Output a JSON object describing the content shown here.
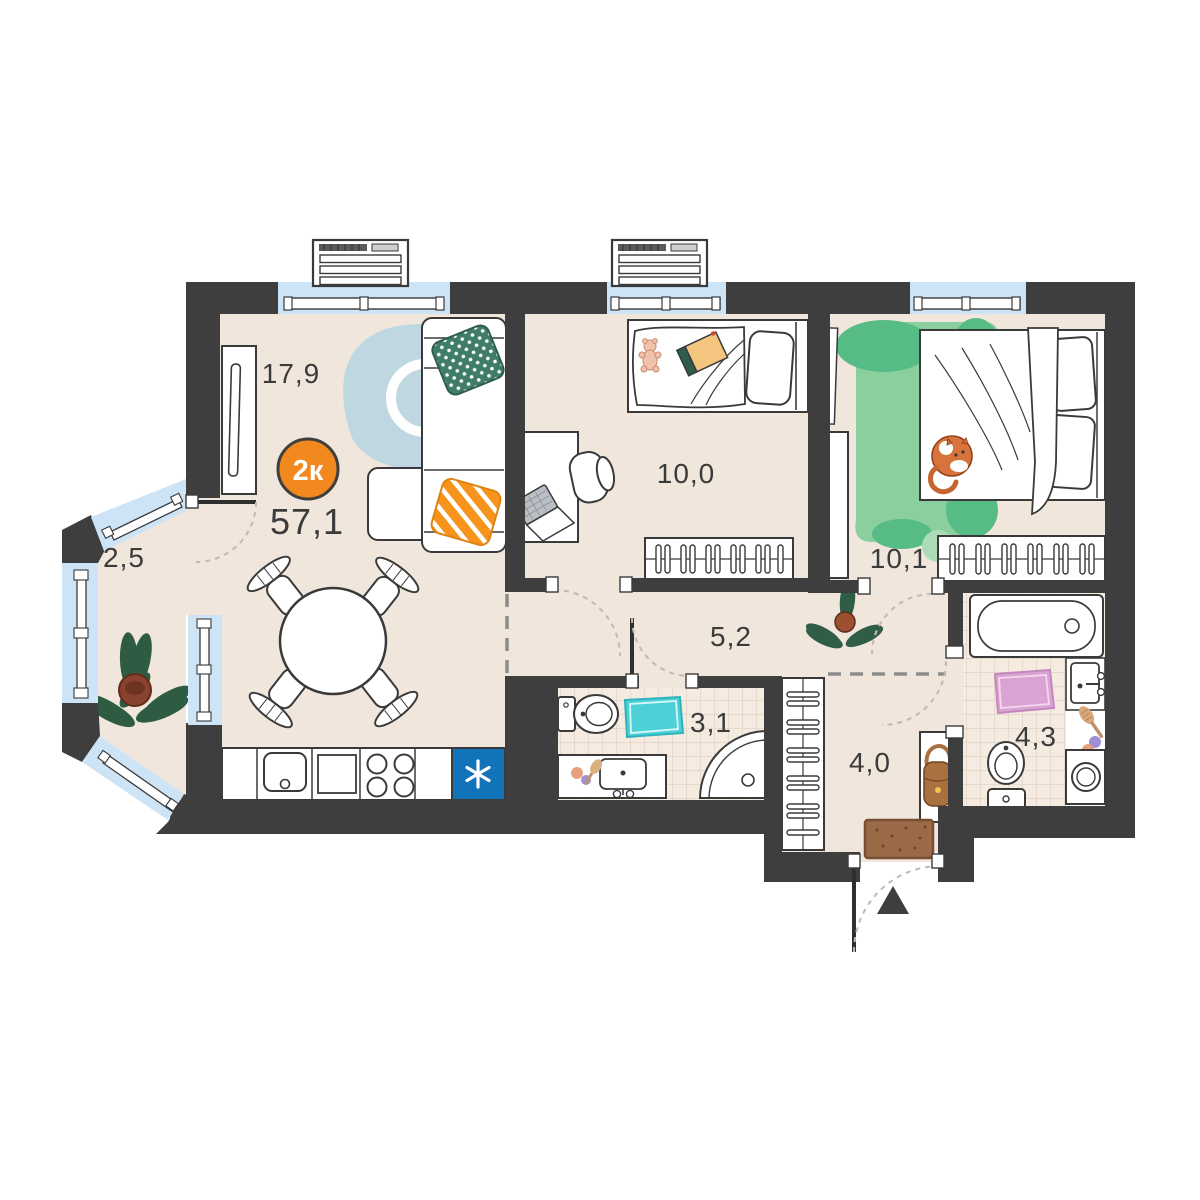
{
  "plan": {
    "type_badge": "2к",
    "total_area": "57,1",
    "areas": {
      "living": "17,9",
      "balcony": "2,5",
      "kids_bedroom": "10,0",
      "bedroom": "10,1",
      "hallway": "5,2",
      "bathroom_small": "3,1",
      "entry_hall": "4,0",
      "bathroom_big": "4,3"
    },
    "colors": {
      "wall": "#3e3e3e",
      "floor": "#f0e6dc",
      "tile_floor": "#f5ebe1",
      "window": "#cde3f6",
      "badge": "#f1891f",
      "fridge": "#1173b9",
      "rug_blue": "#bed7e1",
      "rug_green": "#8ccf9f",
      "rug_teal": "#4ed0d8",
      "rug_pink": "#dba3d4",
      "pillow_green": "#3f7d6a",
      "pillow_orange": "#f6941d"
    }
  }
}
